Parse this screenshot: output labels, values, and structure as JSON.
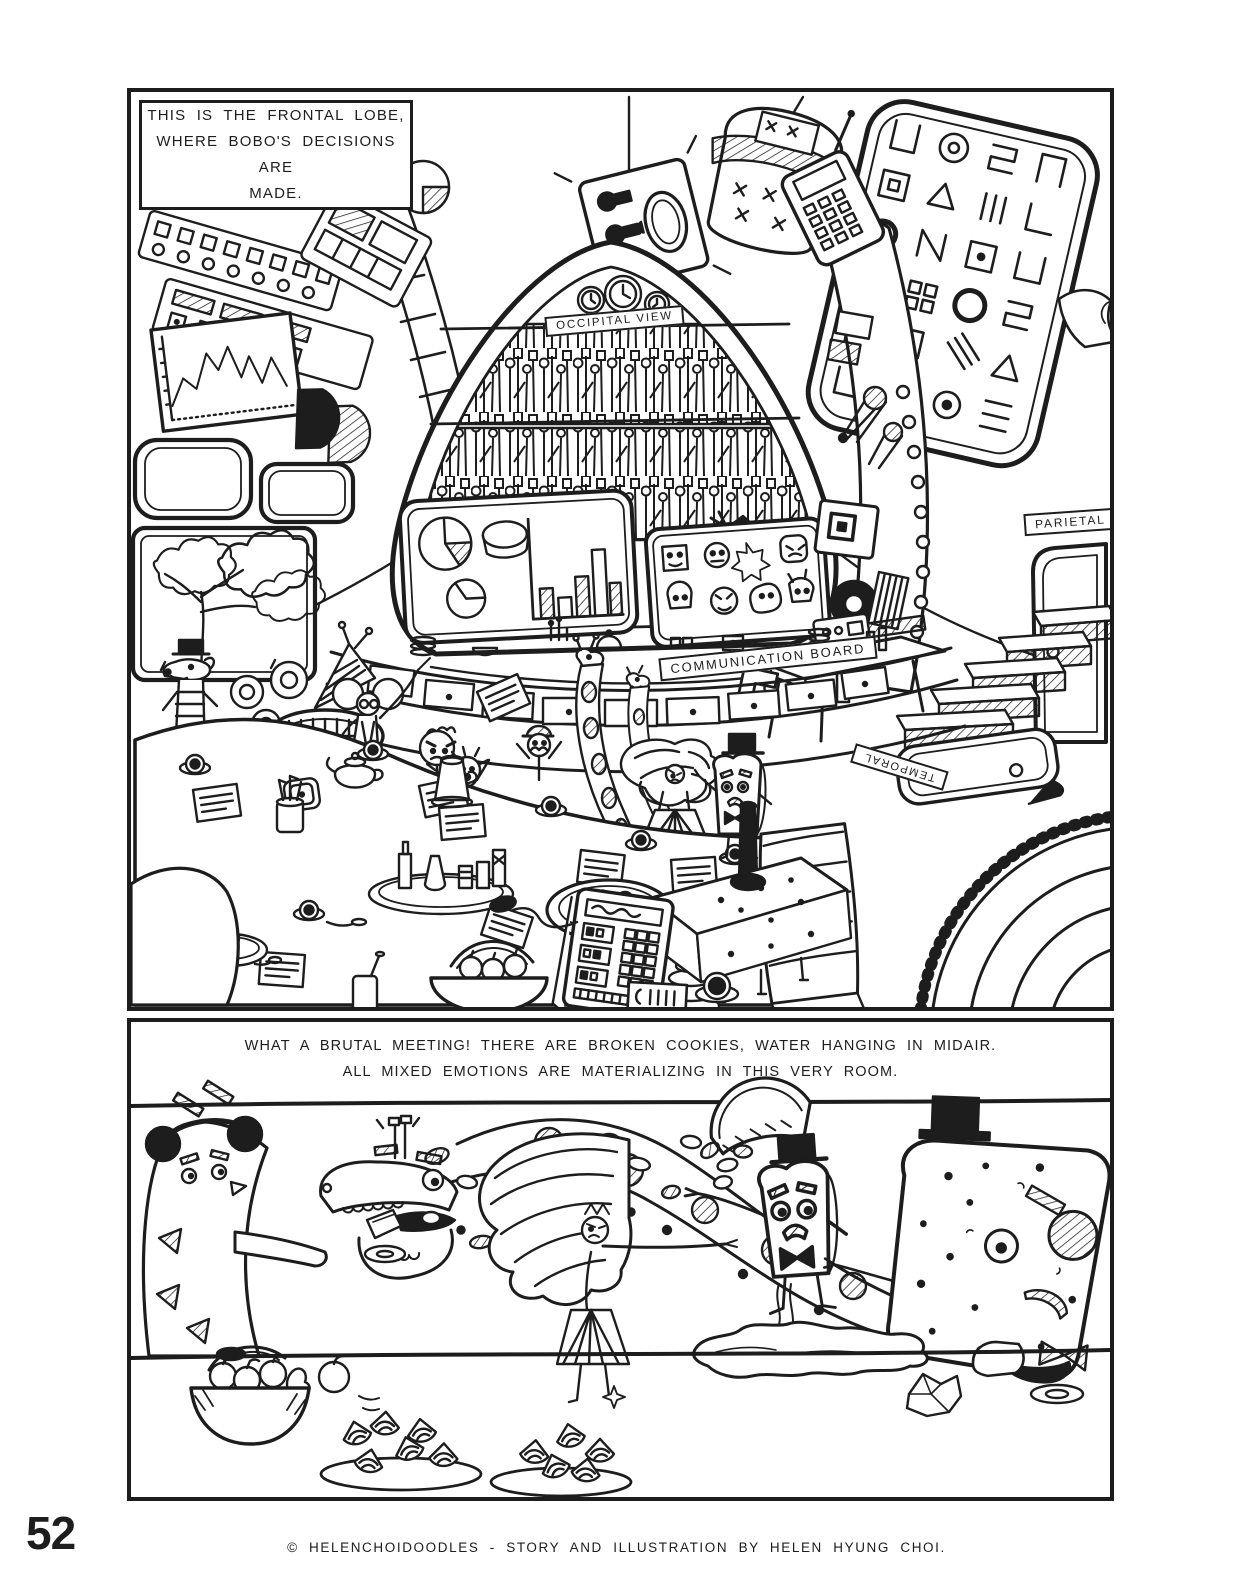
{
  "page": {
    "number": "52",
    "credit": "© HELENCHOIDOODLES - STORY AND ILLUSTRATION BY HELEN HYUNG CHOI.",
    "ink_color": "#1d1d1d",
    "paper_color": "#ffffff"
  },
  "panel1": {
    "caption_line1": "THIS IS THE FRONTAL LOBE,",
    "caption_line2": "WHERE BOBO'S DECISIONS ARE",
    "caption_line3": "MADE.",
    "occipital_label": "OCCIPITAL VIEW",
    "communication_label": "COMMUNICATION BOARD",
    "parietal_label": "PARIETAL LO",
    "temporal_label": "TEMPORAL"
  },
  "panel2": {
    "caption_line1": "WHAT A BRUTAL MEETING! THERE ARE BROKEN COOKIES, WATER HANGING IN MIDAIR.",
    "caption_line2": "ALL MIXED EMOTIONS ARE MATERIALIZING IN THIS VERY ROOM."
  }
}
